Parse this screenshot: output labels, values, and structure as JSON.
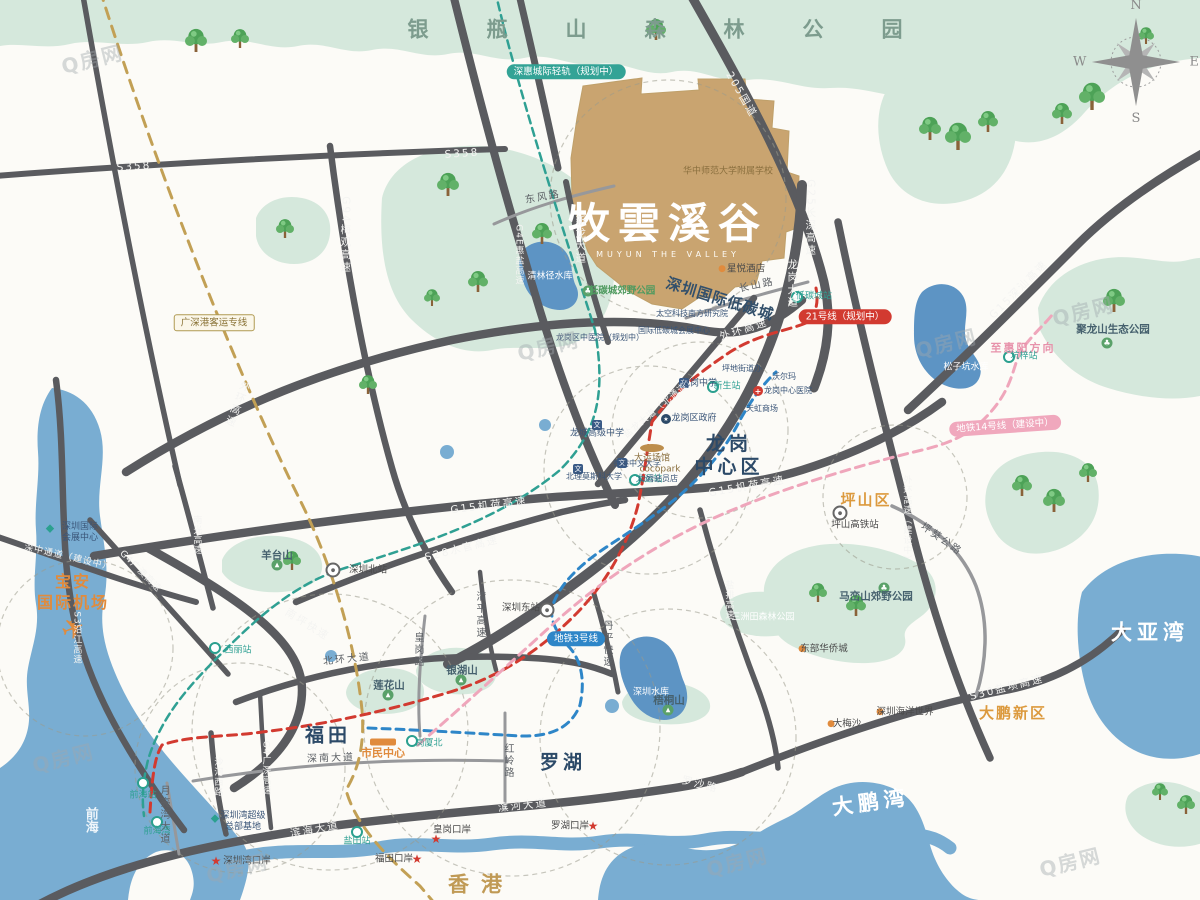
{
  "watermark_text": "Q房网",
  "compass": {
    "n": "N",
    "e": "E",
    "s": "S",
    "w": "W"
  },
  "colors": {
    "park": "#d5e8dc",
    "water": "#79add2",
    "reservoir": "#5d94c4",
    "road": "#5a5b5f",
    "project": "#c9a470",
    "metro_teal": "#2fa093",
    "metro_blue": "#2e86c8",
    "metro_red": "#d23a30",
    "metro_pink": "#efa6bb",
    "rail_gold": "#c2a055"
  },
  "project": {
    "name": "牧雲溪谷",
    "name_en": "MUYUN THE VALLEY"
  },
  "labels": [
    {
      "t": "银瓶山森林公园",
      "x": 684,
      "y": 30,
      "c": "f-spaced-green",
      "n": "label-yinpingshan-forest-park"
    },
    {
      "t": "牧雲溪谷",
      "x": 668,
      "y": 224,
      "c": "logo",
      "n": "project-logo"
    },
    {
      "t": "MUYUN THE VALLEY",
      "x": 668,
      "y": 255,
      "c": "logo-en",
      "n": "project-logo-en"
    },
    {
      "t": "华中师范大学附属学校",
      "x": 728,
      "y": 172,
      "c": "t-gold",
      "n": "label-school"
    },
    {
      "t": "星悦酒店",
      "x": 746,
      "y": 269,
      "c": "t-dark",
      "n": "label-hotel"
    },
    {
      "t": "深圳国际低碳城",
      "x": 720,
      "y": 299,
      "c": "f-navy-md",
      "r": 17,
      "n": "label-low-carbon-city"
    },
    {
      "t": "龙岗\n中心区",
      "x": 729,
      "y": 456,
      "c": "f-navy-lg",
      "n": "label-longgang-center"
    },
    {
      "t": "坪山区",
      "x": 866,
      "y": 500,
      "c": "f-orange-lg",
      "n": "label-pingshan"
    },
    {
      "t": "福田",
      "x": 328,
      "y": 736,
      "c": "f-navy-lg",
      "n": "label-futian"
    },
    {
      "t": "罗湖",
      "x": 563,
      "y": 763,
      "c": "f-navy-lg",
      "n": "label-luohu"
    },
    {
      "t": "香港",
      "x": 481,
      "y": 885,
      "c": "f-gold-lg",
      "n": "label-hongkong"
    },
    {
      "t": "大亚湾",
      "x": 1150,
      "y": 633,
      "c": "f-white-lg",
      "n": "label-dayawan"
    },
    {
      "t": "大鹏湾",
      "x": 871,
      "y": 803,
      "c": "f-white-lg",
      "r": -8,
      "n": "label-dapengwan"
    },
    {
      "t": "大鹏新区",
      "x": 1013,
      "y": 713,
      "c": "f-orange-lg",
      "n": "label-dapeng-new-district"
    },
    {
      "t": "宝安\n国际机场",
      "x": 73,
      "y": 593,
      "c": "f-airport",
      "n": "label-airport"
    },
    {
      "t": "前海",
      "x": 90,
      "y": 820,
      "c": "f-white-vert vert",
      "n": "label-qianhai"
    },
    {
      "t": "S358",
      "x": 134,
      "y": 167,
      "c": "road-w",
      "r": -4
    },
    {
      "t": "S358",
      "x": 462,
      "y": 154,
      "c": "road-w",
      "r": -4
    },
    {
      "t": "G94梅观高速",
      "x": 345,
      "y": 235,
      "c": "road-w vert"
    },
    {
      "t": "东风路",
      "x": 543,
      "y": 198,
      "c": "road-d",
      "r": -10
    },
    {
      "t": "新龙大道",
      "x": 580,
      "y": 240,
      "c": "road-w vert"
    },
    {
      "t": "G4E惠盐高速",
      "x": 518,
      "y": 255,
      "c": "road-w9 vert"
    },
    {
      "t": "205国道",
      "x": 741,
      "y": 95,
      "c": "road-w",
      "r": 60
    },
    {
      "t": "G25长深高速",
      "x": 810,
      "y": 218,
      "c": "road-w vert"
    },
    {
      "t": "长山路",
      "x": 757,
      "y": 286,
      "c": "road-d",
      "r": -12
    },
    {
      "t": "龙岗大道",
      "x": 792,
      "y": 284,
      "c": "road-w vert"
    },
    {
      "t": "外环高速",
      "x": 744,
      "y": 330,
      "c": "road-w",
      "r": -18
    },
    {
      "t": "外环高速",
      "x": 237,
      "y": 404,
      "c": "road-w vert",
      "r": 22
    },
    {
      "t": "盐龙大道（北通道）",
      "x": 660,
      "y": 408,
      "c": "road-w9",
      "r": -40
    },
    {
      "t": "G15机荷高速",
      "x": 489,
      "y": 506,
      "c": "road-w",
      "r": -7
    },
    {
      "t": "G15机荷高速",
      "x": 747,
      "y": 487,
      "c": "road-w",
      "r": -10
    },
    {
      "t": "G15深汕高速",
      "x": 1019,
      "y": 290,
      "c": "road-w",
      "r": -45
    },
    {
      "t": "S28水官高速",
      "x": 462,
      "y": 549,
      "c": "road-w",
      "r": -14
    },
    {
      "t": "南坪快速",
      "x": 307,
      "y": 625,
      "c": "road-w",
      "r": 32
    },
    {
      "t": "北环大道",
      "x": 347,
      "y": 660,
      "c": "road-d",
      "r": -6
    },
    {
      "t": "深南大道",
      "x": 331,
      "y": 759,
      "c": "road-d",
      "r": -2
    },
    {
      "t": "滨海大道",
      "x": 315,
      "y": 830,
      "c": "road-w",
      "r": -10
    },
    {
      "t": "滨河大道",
      "x": 523,
      "y": 806,
      "c": "road-w",
      "r": -6
    },
    {
      "t": "罗沙路",
      "x": 700,
      "y": 785,
      "c": "road-w",
      "r": 14
    },
    {
      "t": "S30盐坝高速",
      "x": 1007,
      "y": 688,
      "c": "road-w",
      "r": -14
    },
    {
      "t": "外环高速（建设中）",
      "x": 906,
      "y": 520,
      "c": "road-w9 vert"
    },
    {
      "t": "坪葵公路",
      "x": 941,
      "y": 540,
      "c": "road-d",
      "r": 35
    },
    {
      "t": "丹平快速",
      "x": 606,
      "y": 644,
      "c": "road-d vert"
    },
    {
      "t": "红岭路",
      "x": 507,
      "y": 761,
      "c": "road-d vert"
    },
    {
      "t": "皇岗路",
      "x": 417,
      "y": 650,
      "c": "road-d vert"
    },
    {
      "t": "清平高速",
      "x": 479,
      "y": 615,
      "c": "road-d vert"
    },
    {
      "t": "月亮湾大道",
      "x": 163,
      "y": 815,
      "c": "road-d vert"
    },
    {
      "t": "沙河西路",
      "x": 217,
      "y": 777,
      "c": "road-w9 vert"
    },
    {
      "t": "S3沿江高速",
      "x": 76,
      "y": 638,
      "c": "road-w9 vert"
    },
    {
      "t": "南光高速",
      "x": 196,
      "y": 535,
      "c": "road-w9 vert"
    },
    {
      "t": "G4广澳高速",
      "x": 140,
      "y": 572,
      "c": "road-w9",
      "r": 45
    },
    {
      "t": "G4广深高速",
      "x": 265,
      "y": 768,
      "c": "road-w9 vert"
    },
    {
      "t": "深中通道（建设中）",
      "x": 68,
      "y": 558,
      "c": "road-w9",
      "r": 13
    },
    {
      "t": "盐排高速",
      "x": 728,
      "y": 600,
      "c": "road-w9 vert"
    },
    {
      "t": "深惠城际轻轨（规划中）",
      "x": 566,
      "y": 72,
      "c": "box-teal",
      "n": "rail-label-intercity"
    },
    {
      "t": "21号线（规划中）",
      "x": 845,
      "y": 317,
      "c": "box-red",
      "n": "rail-label-line21"
    },
    {
      "t": "地铁3号线",
      "x": 576,
      "y": 639,
      "c": "box-blue",
      "n": "rail-label-line3"
    },
    {
      "t": "地铁14号线（建设中）",
      "x": 1005,
      "y": 426,
      "c": "box-pink",
      "r": -4,
      "n": "rail-label-line14"
    },
    {
      "t": "广深港客运专线",
      "x": 214,
      "y": 323,
      "c": "box-gold",
      "n": "rail-label-gsh"
    },
    {
      "t": "至惠阳方向",
      "x": 1023,
      "y": 348,
      "c": "t-pink",
      "n": "label-to-huiyang"
    },
    {
      "t": "深圳北站",
      "x": 368,
      "y": 570,
      "c": "t-dark"
    },
    {
      "t": "深圳东站",
      "x": 521,
      "y": 608,
      "c": "t-dark"
    },
    {
      "t": "西丽站",
      "x": 238,
      "y": 651,
      "c": "t-teal"
    },
    {
      "t": "前海站",
      "x": 143,
      "y": 796,
      "c": "t-teal"
    },
    {
      "t": "前海湾",
      "x": 157,
      "y": 832,
      "c": "t-teal"
    },
    {
      "t": "盐田站",
      "x": 357,
      "y": 842,
      "c": "t-teal"
    },
    {
      "t": "岗厦北",
      "x": 429,
      "y": 744,
      "c": "t-teal"
    },
    {
      "t": "大运站",
      "x": 649,
      "y": 480,
      "c": "t-teal"
    },
    {
      "t": "新生站",
      "x": 727,
      "y": 387,
      "c": "t-teal"
    },
    {
      "t": "坑梓站",
      "x": 1024,
      "y": 357,
      "c": "t-teal"
    },
    {
      "t": "低碳城站",
      "x": 814,
      "y": 297,
      "c": "t-teal"
    },
    {
      "t": "坪山高铁站",
      "x": 855,
      "y": 525,
      "c": "t-dark"
    },
    {
      "t": "深圳湾口岸",
      "x": 247,
      "y": 861,
      "c": "t-dark"
    },
    {
      "t": "皇岗口岸",
      "x": 452,
      "y": 830,
      "c": "t-dark"
    },
    {
      "t": "福田口岸",
      "x": 394,
      "y": 859,
      "c": "t-dark"
    },
    {
      "t": "罗湖口岸",
      "x": 570,
      "y": 826,
      "c": "t-dark"
    },
    {
      "t": "深圳海洋世界",
      "x": 905,
      "y": 712,
      "c": "t-dark"
    },
    {
      "t": "大梅沙",
      "x": 847,
      "y": 724,
      "c": "t-dark"
    },
    {
      "t": "东部华侨城",
      "x": 824,
      "y": 649,
      "c": "t-dark"
    },
    {
      "t": "市民中心",
      "x": 383,
      "y": 753,
      "c": "f-orange-md"
    },
    {
      "t": "深圳国际\n会展中心",
      "x": 80,
      "y": 533,
      "c": "t-navy"
    },
    {
      "t": "深圳湾超级\n总部基地",
      "x": 243,
      "y": 822,
      "c": "t-navy"
    },
    {
      "t": "龙岗中学",
      "x": 699,
      "y": 384,
      "c": "t-navy"
    },
    {
      "t": "龙岗区政府",
      "x": 694,
      "y": 419,
      "c": "t-navy"
    },
    {
      "t": "坪地街道办",
      "x": 742,
      "y": 369,
      "c": "t-navy8"
    },
    {
      "t": "沃尔玛",
      "x": 784,
      "y": 377,
      "c": "t-navy8"
    },
    {
      "t": "龙岗中心医院",
      "x": 788,
      "y": 391,
      "c": "t-navy8"
    },
    {
      "t": "天虹商场",
      "x": 762,
      "y": 409,
      "c": "t-navy8"
    },
    {
      "t": "太空科技南方研究院",
      "x": 692,
      "y": 314,
      "c": "t-navy8"
    },
    {
      "t": "国际低碳城会展中心",
      "x": 674,
      "y": 331,
      "c": "t-navy8"
    },
    {
      "t": "龙岗区中医院（规划中）",
      "x": 600,
      "y": 338,
      "c": "t-navy8"
    },
    {
      "t": "龙城高级中学",
      "x": 597,
      "y": 434,
      "c": "t-navy"
    },
    {
      "t": "北理莫斯科大学",
      "x": 594,
      "y": 477,
      "c": "t-navy8"
    },
    {
      "t": "香港中文大学",
      "x": 637,
      "y": 464,
      "c": "t-navy8"
    },
    {
      "t": "cocopark",
      "x": 660,
      "y": 470,
      "c": "t-gold"
    },
    {
      "t": "山姆会员店",
      "x": 658,
      "y": 479,
      "c": "t-navy8"
    },
    {
      "t": "大运场馆",
      "x": 652,
      "y": 459,
      "c": "t-gold"
    },
    {
      "t": "低碳城郊野公园",
      "x": 622,
      "y": 291,
      "c": "t-green"
    },
    {
      "t": "聚龙山生态公园",
      "x": 1113,
      "y": 330,
      "c": "t-area"
    },
    {
      "t": "马峦山郊野公园",
      "x": 876,
      "y": 597,
      "c": "t-area"
    },
    {
      "t": "三洲田森林公园",
      "x": 763,
      "y": 618,
      "c": "t-white"
    },
    {
      "t": "羊台山",
      "x": 277,
      "y": 556,
      "c": "t-area"
    },
    {
      "t": "莲花山",
      "x": 389,
      "y": 686,
      "c": "t-area"
    },
    {
      "t": "银湖山",
      "x": 462,
      "y": 671,
      "c": "t-area"
    },
    {
      "t": "梧桐山",
      "x": 669,
      "y": 701,
      "c": "t-area"
    },
    {
      "t": "松子坑水库",
      "x": 966,
      "y": 368,
      "c": "t-white"
    },
    {
      "t": "清林径水库",
      "x": 550,
      "y": 277,
      "c": "t-white"
    },
    {
      "t": "深圳水库",
      "x": 651,
      "y": 693,
      "c": "t-white"
    }
  ],
  "icon_defs": {
    "metro": {
      "name": "metro-station-icon",
      "glyph": ""
    },
    "rail": {
      "name": "railway-station-icon",
      "glyph": "●"
    },
    "star": {
      "name": "port-star-icon",
      "glyph": "★"
    },
    "dot": {
      "name": "poi-dot-icon",
      "glyph": "●"
    },
    "mtn": {
      "name": "mountain-icon",
      "glyph": "▲"
    },
    "park": {
      "name": "park-icon",
      "glyph": "♣"
    },
    "school": {
      "name": "school-icon",
      "glyph": "文"
    },
    "hosp": {
      "name": "hospital-icon",
      "glyph": "+"
    },
    "gov": {
      "name": "government-icon",
      "glyph": "★"
    },
    "civic": {
      "name": "civic-center-icon",
      "glyph": ""
    },
    "stadium": {
      "name": "stadium-icon",
      "glyph": ""
    },
    "plane": {
      "name": "airport-plane-icon",
      "glyph": "✈"
    },
    "expo": {
      "name": "landmark-icon",
      "glyph": "◆"
    }
  },
  "icons": [
    {
      "k": "metro",
      "x": 215,
      "y": 648
    },
    {
      "k": "metro",
      "x": 143,
      "y": 783
    },
    {
      "k": "metro",
      "x": 157,
      "y": 822
    },
    {
      "k": "metro",
      "x": 357,
      "y": 832
    },
    {
      "k": "metro",
      "x": 412,
      "y": 741
    },
    {
      "k": "metro",
      "x": 635,
      "y": 480
    },
    {
      "k": "metro",
      "x": 713,
      "y": 387
    },
    {
      "k": "metro",
      "x": 1009,
      "y": 357
    },
    {
      "k": "metro",
      "x": 797,
      "y": 297
    },
    {
      "k": "rail",
      "x": 333,
      "y": 570
    },
    {
      "k": "rail",
      "x": 547,
      "y": 610
    },
    {
      "k": "rail",
      "x": 840,
      "y": 513
    },
    {
      "k": "star",
      "x": 216,
      "y": 861
    },
    {
      "k": "star",
      "x": 436,
      "y": 839
    },
    {
      "k": "star",
      "x": 417,
      "y": 859
    },
    {
      "k": "star",
      "x": 593,
      "y": 826
    },
    {
      "k": "dot",
      "x": 880,
      "y": 712
    },
    {
      "k": "dot",
      "x": 831,
      "y": 724
    },
    {
      "k": "dot",
      "x": 802,
      "y": 649
    },
    {
      "k": "dot",
      "x": 722,
      "y": 269
    },
    {
      "k": "mtn",
      "x": 277,
      "y": 565
    },
    {
      "k": "mtn",
      "x": 388,
      "y": 695
    },
    {
      "k": "mtn",
      "x": 461,
      "y": 680
    },
    {
      "k": "mtn",
      "x": 668,
      "y": 710
    },
    {
      "k": "park",
      "x": 588,
      "y": 291
    },
    {
      "k": "park",
      "x": 1107,
      "y": 343
    },
    {
      "k": "park",
      "x": 884,
      "y": 588
    },
    {
      "k": "school",
      "x": 597,
      "y": 425
    },
    {
      "k": "school",
      "x": 684,
      "y": 383
    },
    {
      "k": "school",
      "x": 578,
      "y": 469
    },
    {
      "k": "school",
      "x": 622,
      "y": 463
    },
    {
      "k": "hosp",
      "x": 758,
      "y": 391
    },
    {
      "k": "gov",
      "x": 666,
      "y": 419
    },
    {
      "k": "civic",
      "x": 383,
      "y": 742
    },
    {
      "k": "stadium",
      "x": 652,
      "y": 448
    },
    {
      "k": "plane",
      "x": 73,
      "y": 629,
      "r": -20
    },
    {
      "k": "expo",
      "x": 50,
      "y": 528
    },
    {
      "k": "expo",
      "x": 215,
      "y": 818
    }
  ],
  "watermarks": [
    {
      "x": 92,
      "y": 58
    },
    {
      "x": 548,
      "y": 345
    },
    {
      "x": 946,
      "y": 342
    },
    {
      "x": 63,
      "y": 757
    },
    {
      "x": 237,
      "y": 867
    },
    {
      "x": 737,
      "y": 861
    },
    {
      "x": 1083,
      "y": 310
    },
    {
      "x": 1070,
      "y": 861
    }
  ]
}
